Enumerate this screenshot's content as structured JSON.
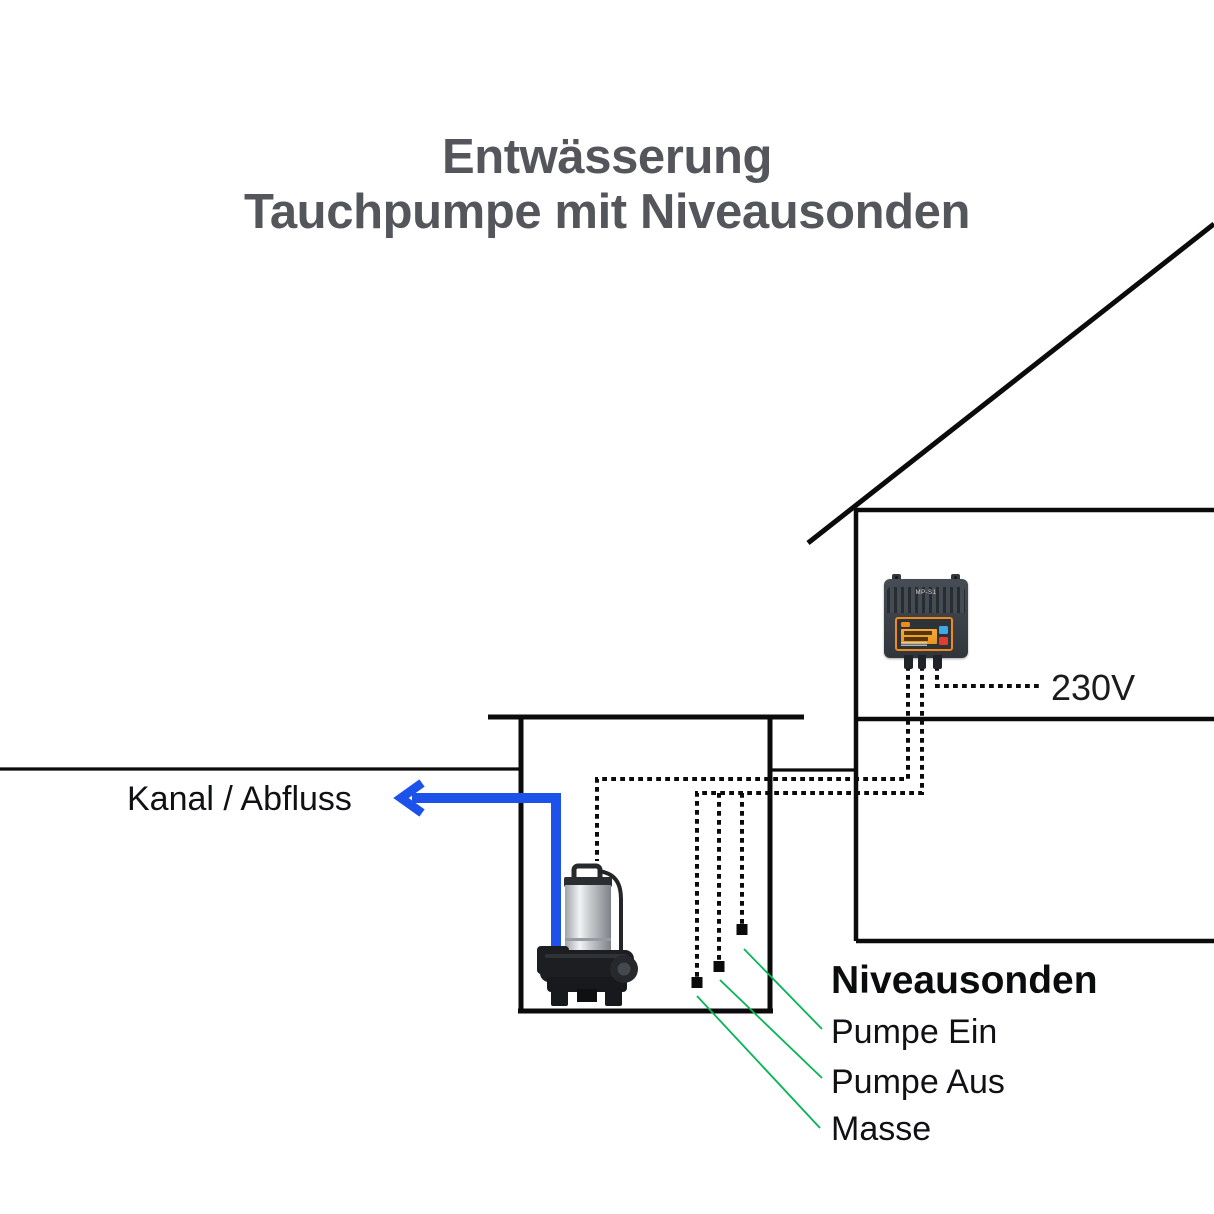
{
  "title": {
    "line1": "Entwässerung",
    "line2": "Tauchpumpe mit Niveausonden"
  },
  "labels": {
    "drain": "Kanal / Abfluss",
    "power": "230V"
  },
  "probes": {
    "heading": "Niveausonden",
    "items": [
      "Pumpe Ein",
      "Pumpe Aus",
      "Masse"
    ]
  },
  "controller": {
    "model": "MP-S1"
  },
  "colors": {
    "pipe_blue": "#1d52ea",
    "probe_green": "#07b456",
    "title_gray": "#54565b",
    "line_black": "#0b0b0c",
    "controller_orange": "#ee8a1e"
  }
}
